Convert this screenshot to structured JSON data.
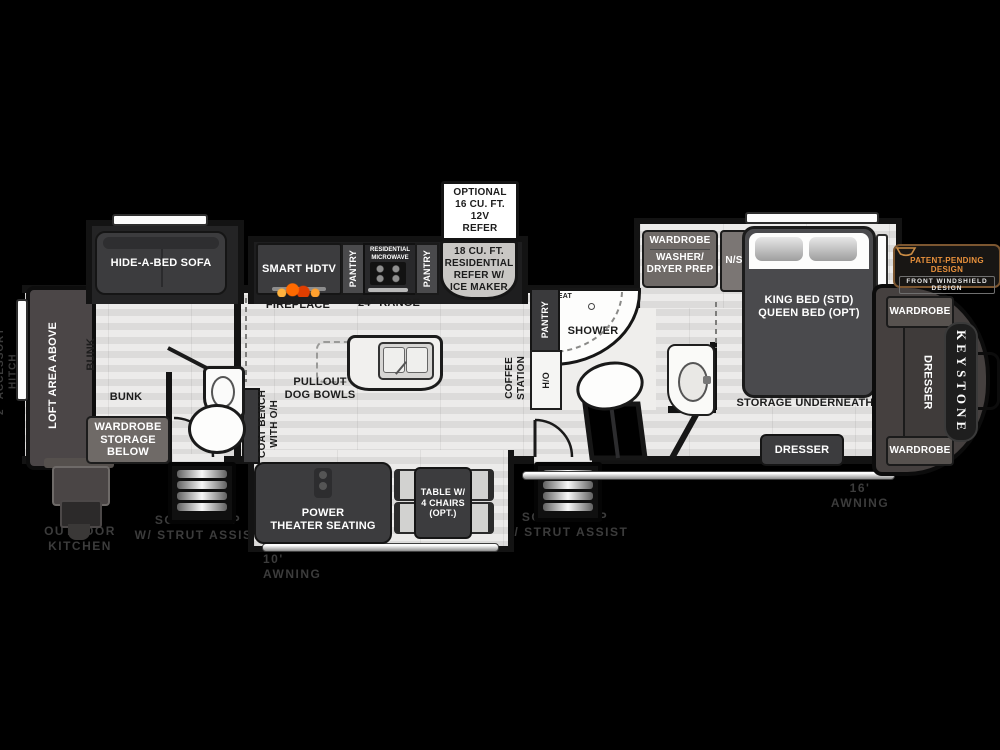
{
  "colors": {
    "background": "#000000",
    "floor": "#e4e3e2",
    "wall": "#131313",
    "furniture_dark": "#3c3c3e",
    "cabinet_gray": "#6f6a67",
    "flame_orange": "#ff7a1a",
    "badge_orange": "#e8913c",
    "dim_label": "#3c3c3c"
  },
  "garage": {
    "loft": "LOFT AREA ABOVE",
    "bunk_side": "BUNK",
    "bunk_rear": "BUNK",
    "wardrobe_storage": [
      "WARDROBE",
      "STORAGE",
      "BELOW"
    ],
    "hitch": "2\" ACCESSORY HITCH",
    "outdoor_kitchen": [
      "OUTDOOR",
      "KITCHEN"
    ]
  },
  "steps": {
    "left": [
      "SOLID STEP",
      "W/ STRUT ASSIST"
    ],
    "right": [
      "SOLID STEP",
      "W/ STRUT ASSIST"
    ]
  },
  "living": {
    "sofa": "HIDE-A-BED SOFA",
    "coat_bench": [
      "COAT BENCH",
      "WITH O/H"
    ],
    "theater": [
      "POWER",
      "THEATER SEATING"
    ],
    "table": [
      "TABLE W/",
      "4 CHAIRS",
      "(OPT.)"
    ],
    "awning": "10' AWNING"
  },
  "kitchen": {
    "smart_hdtv": "SMART HDTV",
    "fireplace": "FIREPLACE",
    "pantry_left": "PANTRY",
    "pantry_right": "PANTRY",
    "microwave": [
      "RESIDENTIAL",
      "MICROWAVE"
    ],
    "range": "24\" RANGE",
    "refer": [
      "18 CU. FT.",
      "RESIDENTIAL",
      "REFER W/",
      "ICE MAKER"
    ],
    "optional_refer": [
      "OPTIONAL",
      "16 CU. FT.",
      "12V",
      "REFER"
    ],
    "island": [
      "PULLOUT",
      "DOG BOWLS"
    ]
  },
  "bath": {
    "pantry": "PANTRY",
    "seat": "SEAT",
    "shower": "SHOWER",
    "water_heater": "H/O",
    "coffee": [
      "COFFEE",
      "STATION"
    ]
  },
  "bedroom": {
    "wardrobe": "WARDROBE",
    "washer_dryer": [
      "WASHER/",
      "DRYER PREP"
    ],
    "nightstand": "N/S",
    "bed": [
      "KING BED (STD)",
      "QUEEN BED (OPT)"
    ],
    "storage": "STORAGE  UNDERNEATH",
    "dresser": "DRESSER",
    "awning": "16' AWNING"
  },
  "front_cap": {
    "wardrobe_top": "WARDROBE",
    "dresser": "DRESSER",
    "wardrobe_bottom": "WARDROBE"
  },
  "brand": {
    "logo": "KEYSTONE"
  },
  "badge": {
    "line1": "PATENT-PENDING DESIGN",
    "line2": "FRONT WINDSHIELD DESIGN"
  }
}
